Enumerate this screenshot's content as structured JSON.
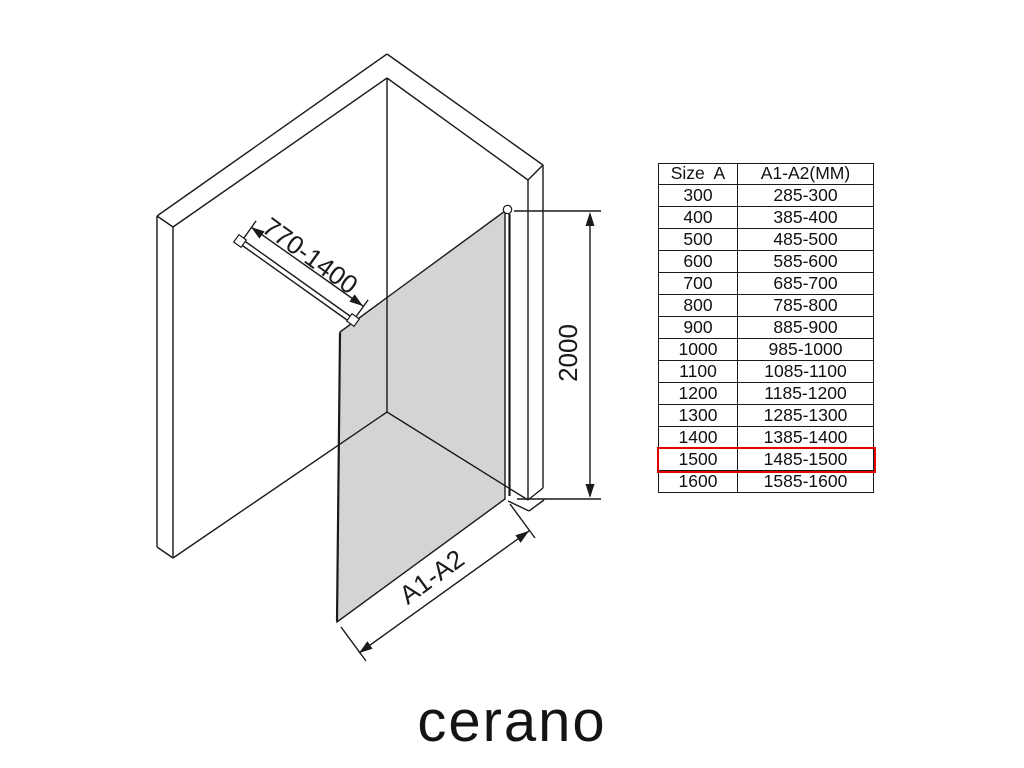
{
  "brand": {
    "logo_text": "cerano"
  },
  "diagram": {
    "support_bar_dimension": "770-1400",
    "height_dimension": "2000",
    "width_dimension": "A1-A2",
    "glass_color": "#d4d4d4",
    "line_color": "#1a1a1a",
    "highlight_color": "#e60000"
  },
  "table": {
    "headers": {
      "size": "Size  A",
      "range": "A1-A2(MM)"
    },
    "rows": [
      {
        "size": "300",
        "range": "285-300"
      },
      {
        "size": "400",
        "range": "385-400"
      },
      {
        "size": "500",
        "range": "485-500"
      },
      {
        "size": "600",
        "range": "585-600"
      },
      {
        "size": "700",
        "range": "685-700"
      },
      {
        "size": "800",
        "range": "785-800"
      },
      {
        "size": "900",
        "range": "885-900"
      },
      {
        "size": "1000",
        "range": "985-1000"
      },
      {
        "size": "1100",
        "range": "1085-1100"
      },
      {
        "size": "1200",
        "range": "1185-1200"
      },
      {
        "size": "1300",
        "range": "1285-1300"
      },
      {
        "size": "1400",
        "range": "1385-1400"
      },
      {
        "size": "1500",
        "range": "1485-1500",
        "highlighted": true
      },
      {
        "size": "1600",
        "range": "1585-1600"
      }
    ]
  }
}
